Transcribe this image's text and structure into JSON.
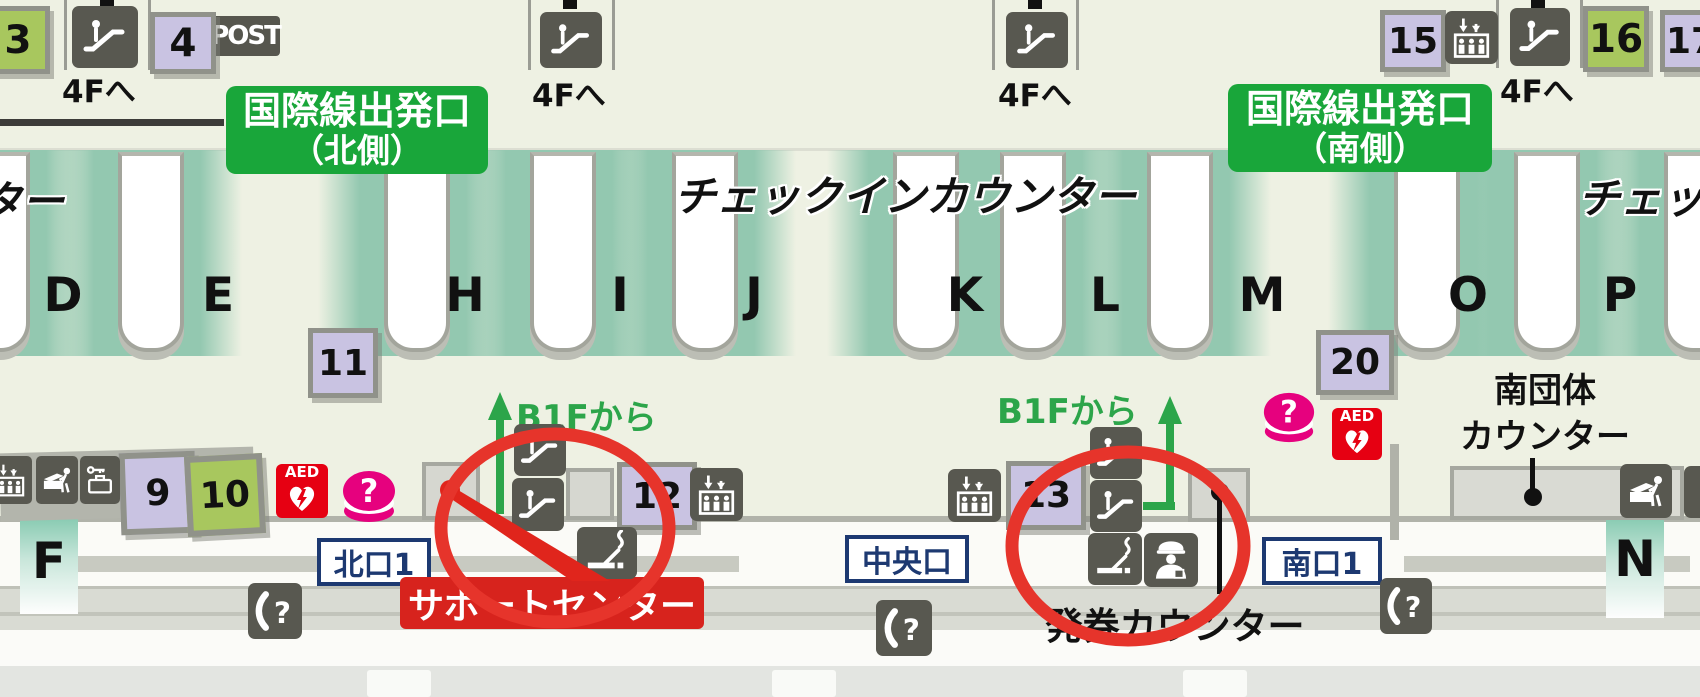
{
  "colors": {
    "floor": "#eef1e3",
    "band_teal": "#93c8b0",
    "gate_green": "#19a63a",
    "stand_purple": "#c9c3e2",
    "stand_green": "#a8c75e",
    "icon_gray": "#585850",
    "annotation_red": "#e6342b",
    "support_red": "#d7231d",
    "info_pink": "#e6017e",
    "aed_red": "#e60012",
    "exit_navy": "#1d3971",
    "b1f_green": "#2ca54a"
  },
  "gates": {
    "north": {
      "line1": "国際線出発口",
      "line2": "（北側）"
    },
    "south": {
      "line1": "国際線出発口",
      "line2": "（南側）"
    }
  },
  "floor_links": {
    "to_4f": "4Fへ",
    "from_b1f": "B1Fから"
  },
  "checkin": {
    "center": "チェックインカウンター",
    "left_partial": "ンター",
    "right_partial": "チェック"
  },
  "counter_rows": [
    "D",
    "E",
    "H",
    "I",
    "J",
    "K",
    "L",
    "M",
    "O",
    "P"
  ],
  "zone_letters": {
    "left": "F",
    "right": "N"
  },
  "stands": {
    "s3": "3",
    "s4": "4",
    "s9": "9",
    "s10": "10",
    "s11": "11",
    "s12": "12",
    "s13": "13",
    "s15": "15",
    "s16": "16",
    "s17": "17",
    "s20": "20"
  },
  "exits": {
    "north": "北口1",
    "central": "中央口",
    "south": "南口1"
  },
  "labels": {
    "post": "POST",
    "support_center": "サポートセンター",
    "ticket_counter": "発券カウンター",
    "south_group_line1": "南団体",
    "south_group_line2": "カウンター",
    "aed": "AED",
    "info_question": "?",
    "phone_question": "?"
  },
  "icons": {
    "escalator": "person-on-escalator",
    "elevator": "up-down-arrows-people-in-box",
    "phone": "handset-with-question-mark",
    "smoking": "cigarette-with-smoke",
    "staff": "uniformed-counter-staff",
    "info": "pink-question-cylinder",
    "aed": "heart-with-lightning-bolt",
    "baggage_wrap": "person-wrapping-baggage",
    "locker": "key-and-suitcase"
  }
}
